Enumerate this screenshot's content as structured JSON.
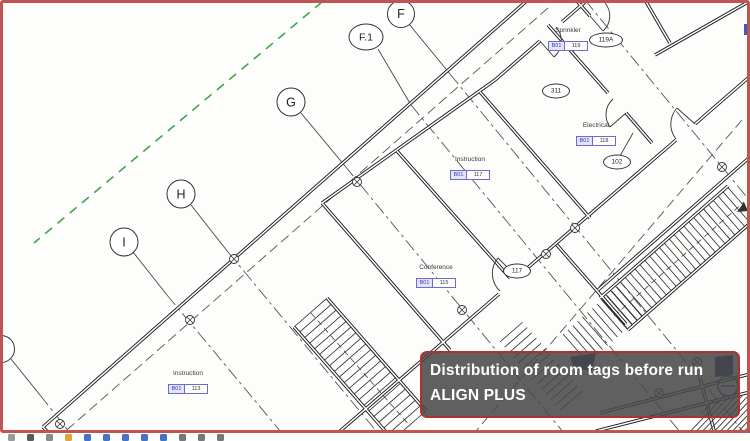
{
  "drawing": {
    "grids": [
      {
        "label": "F"
      },
      {
        "label": "F.1"
      },
      {
        "label": "G"
      },
      {
        "label": "H"
      },
      {
        "label": "I"
      }
    ],
    "rooms": [
      {
        "name": "Sprinkler",
        "code": "B01",
        "number": "119"
      },
      {
        "name": "Electrical",
        "code": "B01",
        "number": "118"
      },
      {
        "name": "Instruction",
        "code": "B01",
        "number": "117"
      },
      {
        "name": "Conference",
        "code": "B01",
        "number": "115"
      },
      {
        "name": "Instruction",
        "code": "B01",
        "number": "113"
      }
    ],
    "doors": [
      {
        "label": "119A"
      },
      {
        "label": "311"
      },
      {
        "label": "102"
      },
      {
        "label": "117"
      }
    ]
  },
  "caption": {
    "line1": "Distribution of room tags before run",
    "line2": "ALIGN PLUS"
  },
  "colors": {
    "frame": "#bf5450",
    "caption_border": "#b03030",
    "caption_fill": "rgba(72,72,72,0.87)",
    "grid_green": "#3aa84c",
    "tag_blue": "#6b6bd0",
    "symbol_navy": "#24406e",
    "symbol_blue": "#3b5bbf"
  },
  "view_bar": {
    "icons": [
      {
        "name": "view-control-icon",
        "color": "#9a9a9a"
      },
      {
        "name": "view-control-icon",
        "color": "#5a5a5a"
      },
      {
        "name": "view-control-icon",
        "color": "#8a8a8a"
      },
      {
        "name": "view-control-icon",
        "color": "#e2a33d"
      },
      {
        "name": "view-control-icon",
        "color": "#4472c4"
      },
      {
        "name": "view-control-icon",
        "color": "#4472c4"
      },
      {
        "name": "view-control-icon",
        "color": "#4472c4"
      },
      {
        "name": "view-control-icon",
        "color": "#4472c4"
      },
      {
        "name": "view-control-icon",
        "color": "#4472c4"
      },
      {
        "name": "view-control-icon",
        "color": "#777777"
      },
      {
        "name": "view-control-icon",
        "color": "#777777"
      },
      {
        "name": "view-control-icon",
        "color": "#777777"
      }
    ]
  }
}
